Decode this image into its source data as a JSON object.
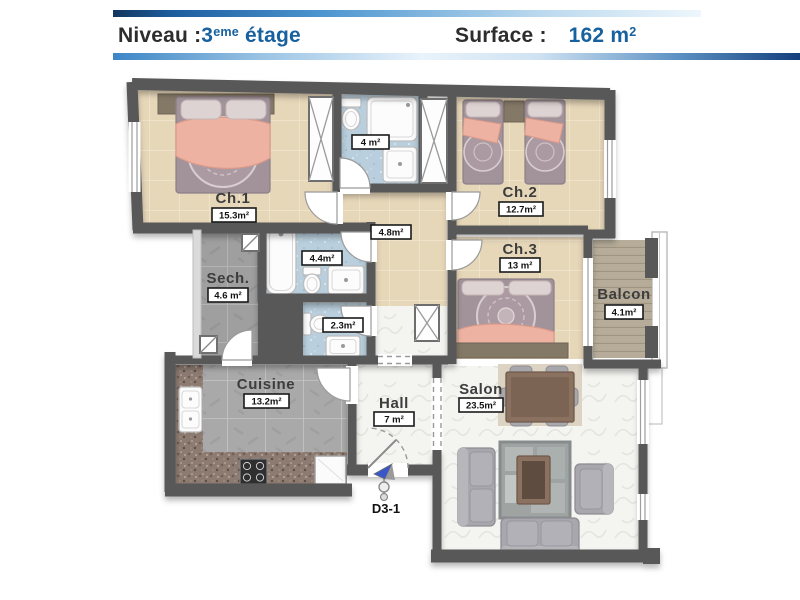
{
  "header": {
    "niveau_label": "Niveau :",
    "floor_number": "3",
    "floor_sup": "eme",
    "floor_suffix": " étage",
    "surface_label": "Surface :",
    "surface_value": "162 m",
    "surface_sup": "2"
  },
  "unit_label": "D3-1",
  "rooms": {
    "ch1": {
      "name": "Ch.1",
      "area": "15.3m²"
    },
    "ch2": {
      "name": "Ch.2",
      "area": "12.7m²"
    },
    "ch3": {
      "name": "Ch.3",
      "area": "13 m²"
    },
    "bath_top": {
      "area": "4 m²"
    },
    "bath_mid": {
      "area": "4.4m²"
    },
    "wc": {
      "area": "2.3m²"
    },
    "degagement": {
      "area": "4.8m²"
    },
    "sech": {
      "name": "Sech.",
      "area": "4.6 m²"
    },
    "cuisine": {
      "name": "Cuisine",
      "area": "13.2m²"
    },
    "hall": {
      "name": "Hall",
      "area": "7 m²"
    },
    "salon": {
      "name": "Salon",
      "area": "23.5m²"
    },
    "balcon": {
      "name": "Balcon",
      "area": "4.1m²"
    }
  },
  "colors": {
    "accent_blue": "#17619f",
    "wall_gray": "#585858",
    "bedroom_floor": "#e7d7b9",
    "bath_floor": "#b9cfdd",
    "stone_floor": "#a9a9a9",
    "marble_floor": "#f4f4f1",
    "deck_floor": "#b6ac99",
    "bed_fabric": "#a2929a",
    "blanket_pink": "#eeb2a2"
  }
}
